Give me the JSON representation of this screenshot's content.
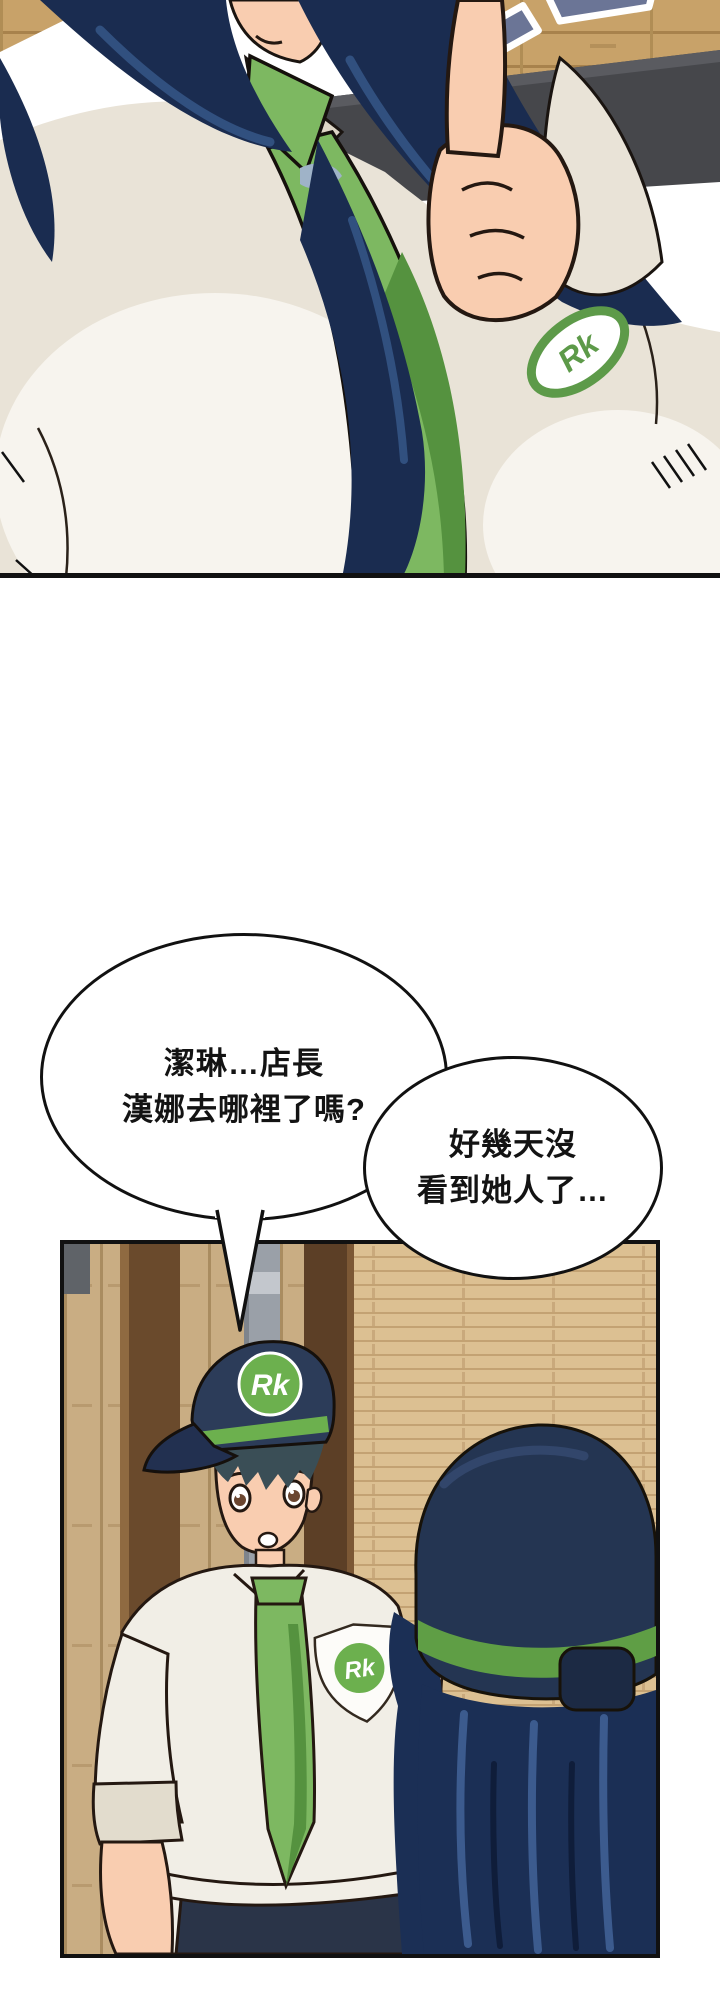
{
  "page_type": "comic-page",
  "speech_bubbles": [
    {
      "id": "bubble-left",
      "lines": [
        "潔琳…店長",
        "漢娜去哪裡了嗎?"
      ]
    },
    {
      "id": "bubble-right",
      "lines": [
        "好幾天沒",
        "看到她人了…"
      ]
    }
  ],
  "logos": {
    "brand": "Rk"
  },
  "colors": {
    "tie_green": "#7db861",
    "tie_green_shade": "#55923f",
    "logo_green": "#6cb04e",
    "hair_navy": "#1a2c50",
    "hair_highlight": "#31507f",
    "cap_navy": "#2c3c59",
    "hat_navy": "#243552",
    "shirt_offwhite": "#f1eee6",
    "shirt_shade": "#d9d2c4",
    "skin": "#f9cdb0",
    "wood_top": "#c8a269",
    "wood_plank_light": "#dcc092",
    "wood_plank_vertical": "#c9ad83",
    "wood_pillar_dark": "#6a4a2c",
    "metal_column_gray": "#9aa0a8",
    "shelf_bar_gray": "#46474b",
    "sign_blue": "#6b7596",
    "panel_border": "#111111",
    "trousers_navy": "#2a3448"
  }
}
